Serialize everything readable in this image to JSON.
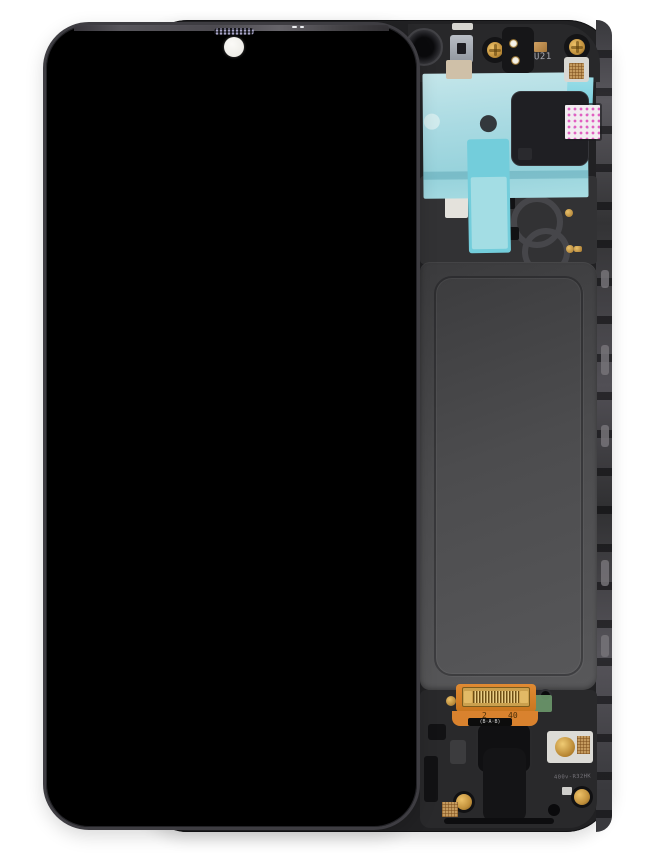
{
  "image": {
    "subject": "Smartphone LCD display assembly with frame, shown from the front (black screen) overlapping the back side of the frame",
    "background_color": "#ffffff"
  },
  "front_display": {
    "screen_color": "#000000",
    "bezel_color": "#3e3d42",
    "camera_hole_color": "#f4f3ee",
    "earpiece_dot_color": "#a9a6c9"
  },
  "back_frame": {
    "body_color": "#212123",
    "back_panel_color": "#4c4c4e",
    "adhesive_film_color": "#a9dae2",
    "adhesive_strip_color": "#73cddb",
    "sticker_dot_color": "#e160c1",
    "gold_color": "#c2913c",
    "copper_color": "#c49a5e",
    "flex_cable_color": "#d9822e",
    "green_tab_color": "#6c986c",
    "labels": {
      "component_marking": "U21",
      "molded_code": "400v-R32HK",
      "flex_mark_left": "2",
      "flex_mark_right": "40",
      "flex_label": "(B·A·B)"
    }
  }
}
